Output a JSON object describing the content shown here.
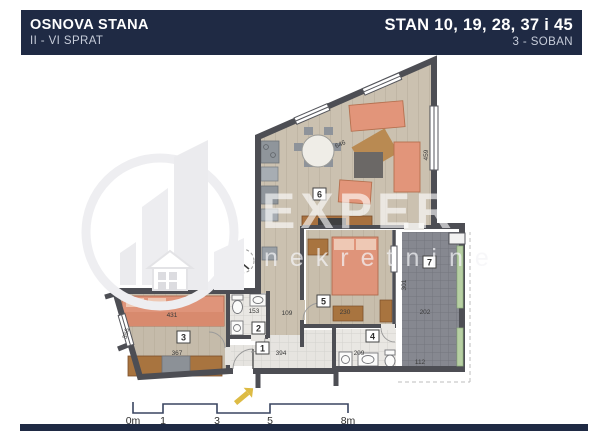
{
  "header": {
    "title_left": "OSNOVA STANA",
    "subtitle_left": "II - VI SPRAT",
    "title_right": "STAN 10, 19, 28, 37 i 45",
    "subtitle_right": "3 - SOBAN"
  },
  "watermark": {
    "brand": "EXPERT",
    "subtitle": "nekretnine"
  },
  "room_numbers": [
    "1",
    "2",
    "3",
    "4",
    "5",
    "6",
    "7"
  ],
  "dimensions": [
    "431",
    "367",
    "356",
    "394",
    "153",
    "209",
    "112",
    "230",
    "301",
    "202",
    "109",
    "646",
    "459"
  ],
  "scalebar": {
    "labels": [
      "0m",
      "1",
      "3",
      "5",
      "8m"
    ]
  },
  "colors": {
    "navy": "#1f2a44",
    "wall": "#4d4e54",
    "wood_floor": "#cbc1b0",
    "tile_floor": "#e6e4e0",
    "terrace_floor": "#868890",
    "furniture_salmon": "#df947a",
    "furniture_brown": "#a8713f",
    "railing_green": "#b7cfa3",
    "watermark_gray": "#ececef",
    "entrance_yellow": "#ddbb44"
  }
}
